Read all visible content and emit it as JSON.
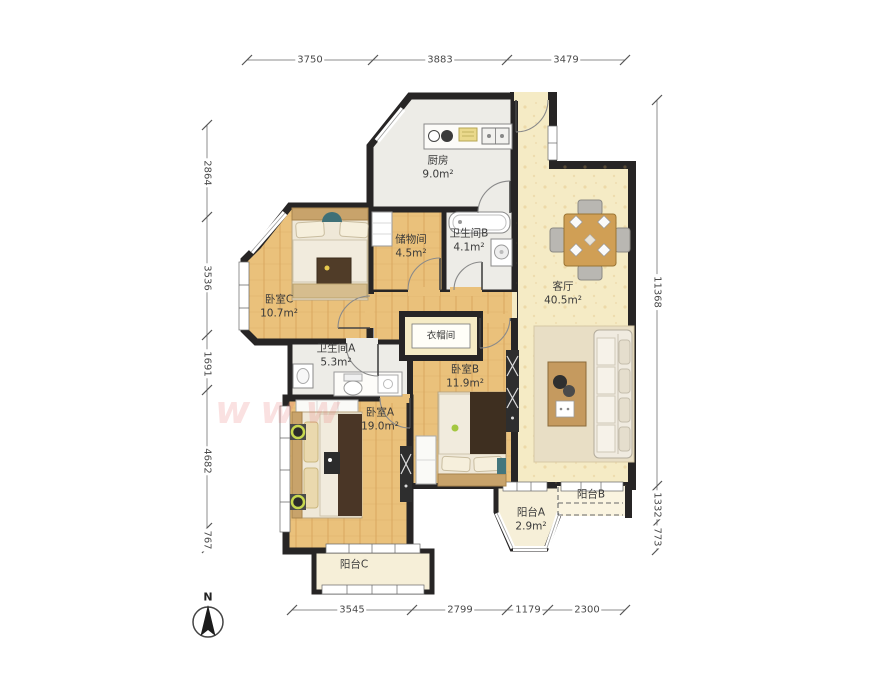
{
  "plan": {
    "rooms": {
      "kitchen": {
        "name": "厨房",
        "area": "9.0m²"
      },
      "storage": {
        "name": "储物间",
        "area": "4.5m²"
      },
      "bathroom_b": {
        "name": "卫生间B",
        "area": "4.1m²"
      },
      "bedroom_c": {
        "name": "卧室C",
        "area": "10.7m²"
      },
      "living": {
        "name": "客厅",
        "area": "40.5m²"
      },
      "bathroom_a": {
        "name": "卫生间A",
        "area": "5.3m²"
      },
      "closet": {
        "name": "衣帽间"
      },
      "bedroom_b": {
        "name": "卧室B",
        "area": "11.9m²"
      },
      "bedroom_a": {
        "name": "卧室A",
        "area": "19.0m²"
      },
      "balcony_a": {
        "name": "阳台A",
        "area": "2.9m²"
      },
      "balcony_b": {
        "name": "阳台B"
      },
      "balcony_c": {
        "name": "阳台C"
      }
    },
    "dimensions": {
      "top": [
        "3750",
        "3883",
        "3479"
      ],
      "left": [
        "2864",
        "3536",
        "1691",
        "4682",
        "767"
      ],
      "right": [
        "11368",
        "1332",
        "773"
      ],
      "bottom": [
        "3545",
        "2799",
        "1179",
        "2300"
      ]
    },
    "compass": {
      "label": "N"
    },
    "watermark": {
      "text": "www"
    },
    "colors": {
      "wall": "#272525",
      "wood": "#eac17b",
      "living": "#f5ebc5",
      "tile": "#edece7",
      "balcony": "#f6efd8",
      "dim_text": "#4a4a4a",
      "watermark": "#e87878"
    }
  }
}
